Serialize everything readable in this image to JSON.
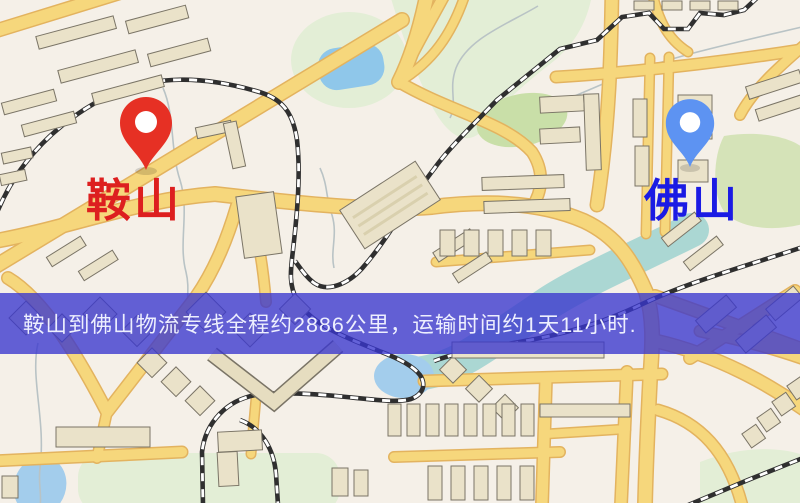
{
  "banner": {
    "text": "鞍山到佛山物流专线全程约2886公里，运输时间约1天11小时."
  },
  "markers": {
    "origin": {
      "label": "鞍山",
      "pin_color": "#e63024",
      "hole_color": "#ffffff",
      "label_color": "#dd1f1f"
    },
    "destination": {
      "label": "佛山",
      "pin_color": "#5d93f2",
      "hole_color": "#ffffff",
      "label_color": "#1b1be4"
    }
  },
  "map": {
    "colors": {
      "background": "#f5f0e8",
      "road_fill": "#f6d77c",
      "road_casing": "#e3b35f",
      "park": "#e3eed6",
      "park_dark": "#c9dfa8",
      "lake_water": "#8fc7ea",
      "river_water": "#9ed2cf",
      "cove_water": "#a3cdec",
      "railway": "#2f2f2f",
      "building_fill": "#eae2c9",
      "building_stroke": "#7a7466",
      "banner_background": "rgba(56,54,206,0.78)",
      "banner_text": "#edeffe"
    }
  }
}
